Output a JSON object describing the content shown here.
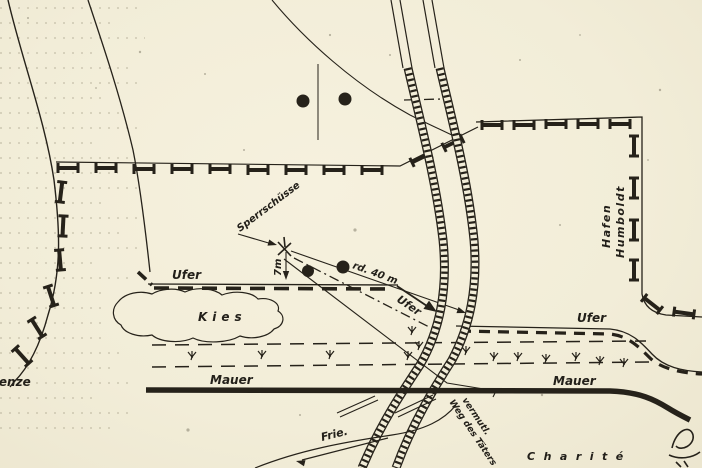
{
  "map": {
    "colors": {
      "paper": "#f2edd8",
      "ink": "#26221a"
    },
    "labels": {
      "sperrschuesse": "Sperrschüsse",
      "seven_m": "7m",
      "forty_m": "rd. 40 m",
      "ufer_west": "Ufer",
      "ufer_bridge": "Ufer",
      "ufer_east": "Ufer",
      "kies": "Kies",
      "grenze_fragment": "renze",
      "mauer_west": "Mauer",
      "mauer_east": "Mauer",
      "humboldt_line1": "Humboldt",
      "humboldt_line2": "Hafen",
      "frie": "Frie.",
      "weg_line1": "vermutl.",
      "weg_line2": "Weg des Täters",
      "charite": "Charité"
    }
  }
}
